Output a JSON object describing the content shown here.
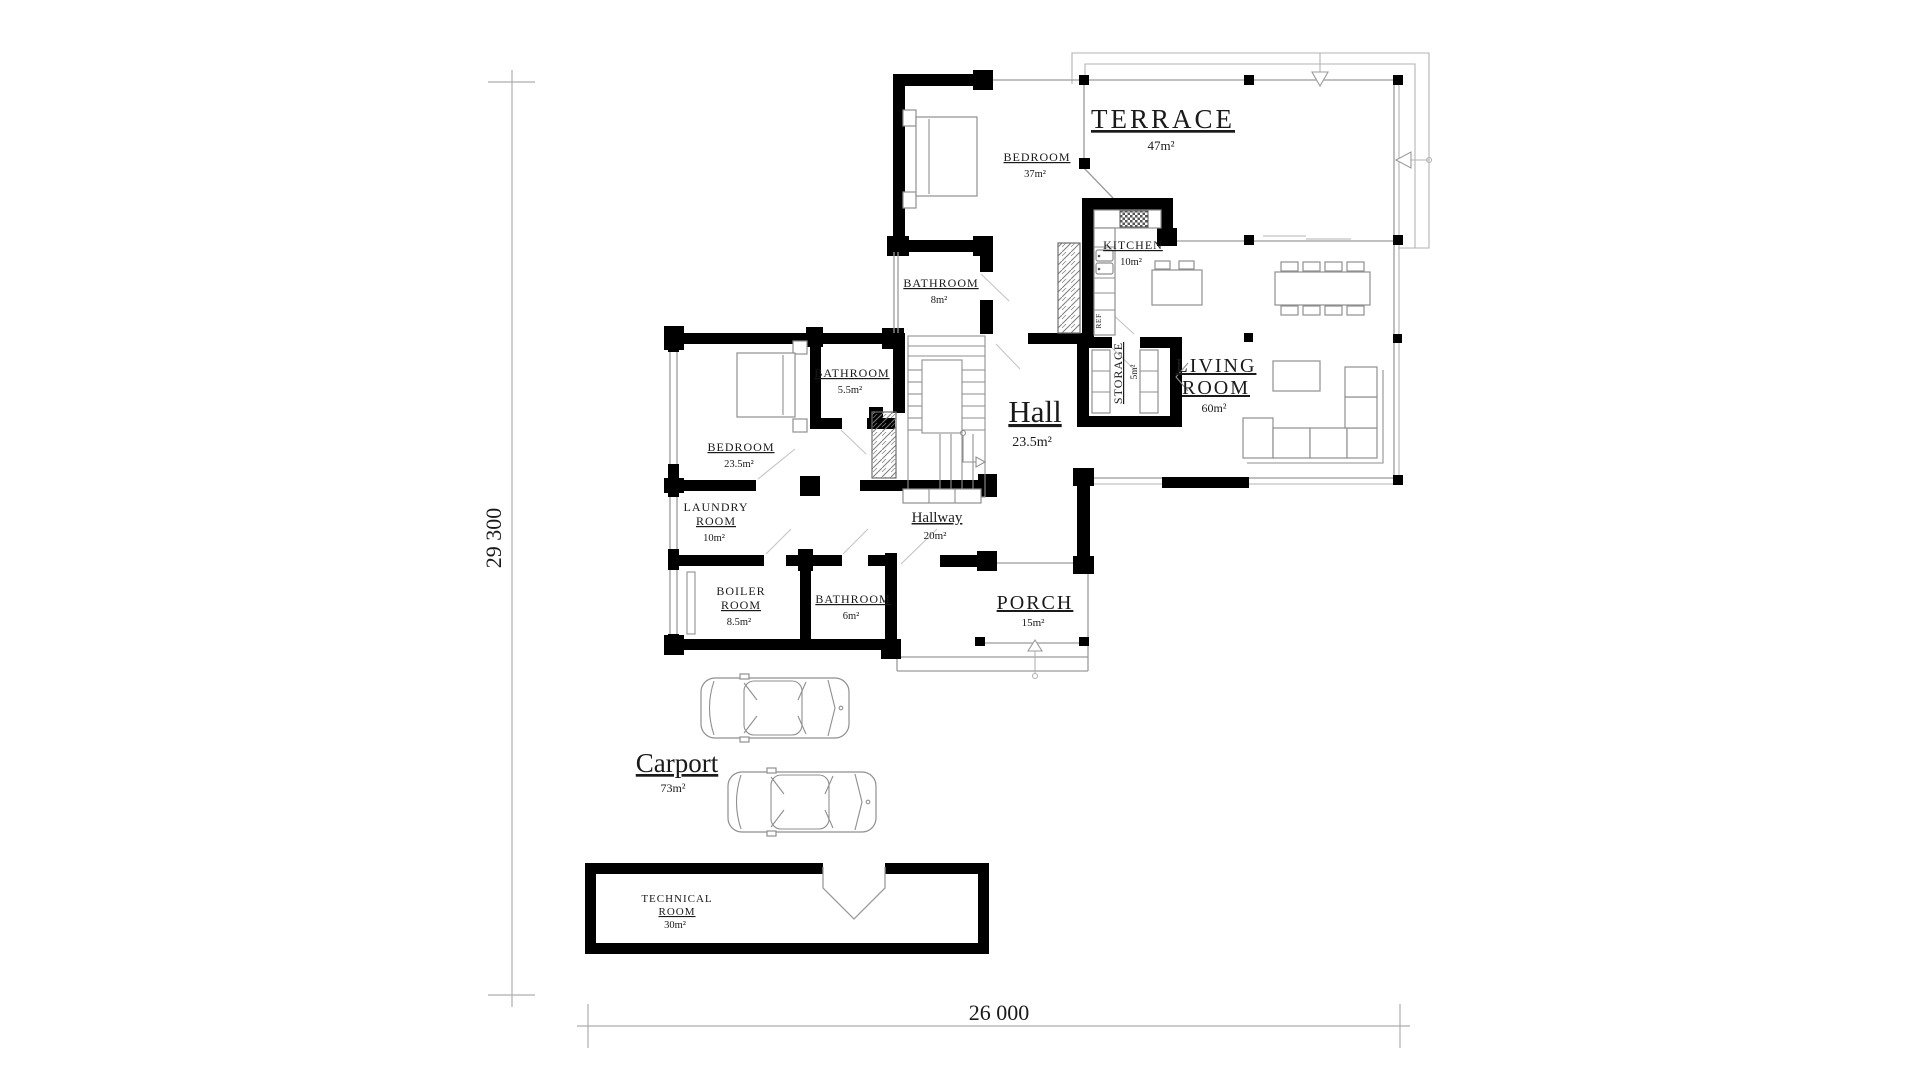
{
  "drawing": {
    "type": "floor-plan",
    "dimensions": {
      "width_label": "26 000",
      "height_label": "29 300"
    },
    "rooms": {
      "terrace": {
        "name": "TERRACE",
        "area": "47m²"
      },
      "bedroom_top": {
        "name": "BEDROOM",
        "area": "37m²"
      },
      "kitchen": {
        "name": "KITCHEN",
        "area": "10m²"
      },
      "bathroom_8": {
        "name": "BATHROOM",
        "area": "8m²"
      },
      "bathroom_55": {
        "name": "BATHROOM",
        "area": "5.5m²"
      },
      "storage": {
        "name": "STORAGE",
        "area": "5m²"
      },
      "living_room": {
        "line1": "LIVING",
        "line2": "ROOM",
        "area": "60m²"
      },
      "hall": {
        "name": "Hall",
        "area": "23.5m²"
      },
      "bedroom_left": {
        "name": "BEDROOM",
        "area": "23.5m²"
      },
      "laundry": {
        "line1": "LAUNDRY",
        "line2": "ROOM",
        "area": "10m²"
      },
      "hallway": {
        "name": "Hallway",
        "area": "20m²"
      },
      "boiler": {
        "line1": "BOILER",
        "line2": "ROOM",
        "area": "8.5m²"
      },
      "bathroom_6": {
        "name": "BATHROOM",
        "area": "6m²"
      },
      "porch": {
        "name": "PORCH",
        "area": "15m²"
      },
      "carport": {
        "name": "Carport",
        "area": "73m²"
      },
      "technical": {
        "line1": "TECHNICAL",
        "line2": "ROOM",
        "area": "30m²"
      }
    },
    "appliances": {
      "fridge_label": "REF"
    }
  }
}
